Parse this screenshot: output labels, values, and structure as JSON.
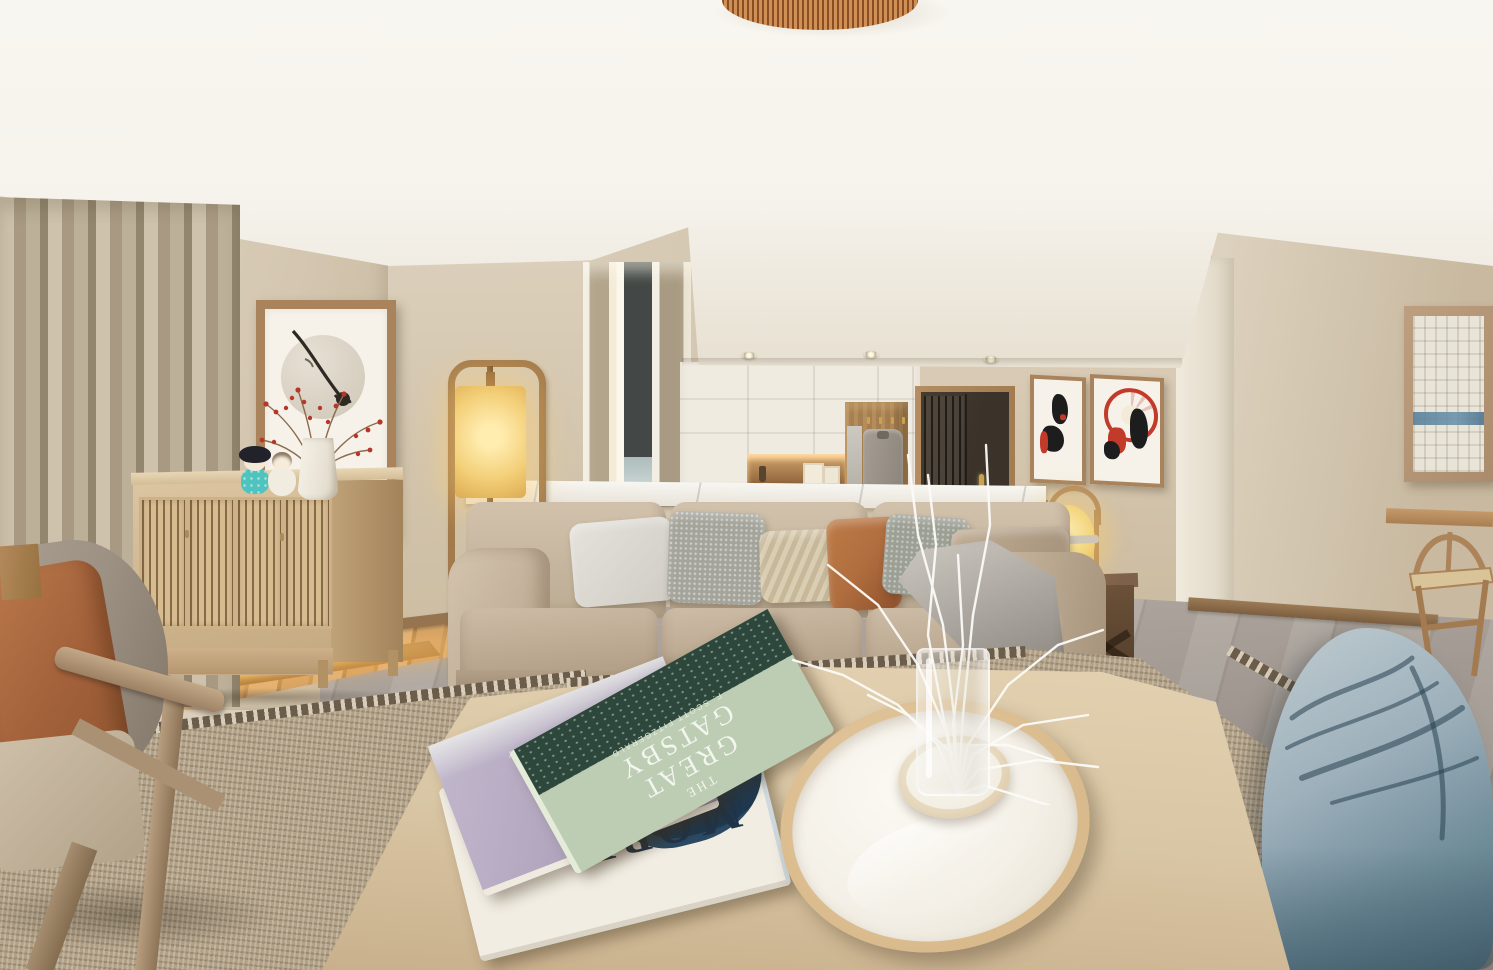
{
  "meta": {
    "description": "Photorealistic 3D render of a Japandi-style open-plan living room with beige sofa, light-wood coffee table, slatted sideboard, kitchen in background and blue bean bag"
  },
  "palette": {
    "ceiling": "#f6f3ec",
    "wall": "#d9cdb9",
    "wall_right": "#d5c9b6",
    "curtain": "#b9ac95",
    "sheer": "#e9e0cf",
    "window_dark": "#3d423f",
    "sky": "#c9d4d4",
    "frame_wood": "#a8835c",
    "art_mat": "#f6f2e9",
    "art_red": "#c23a2a",
    "art_black": "#1d1d1d",
    "cabinet": "#f0ebe1",
    "niche_glow": "#ffd9a0",
    "door": "#3b332a",
    "brass": "#c9a24c",
    "marble": "#edeae2",
    "island_wood": "#b08a60",
    "sideboard": "#d5bd97",
    "platform_glow": "#ffc878",
    "lamp_glow": "#f7d887",
    "lantern_glass": "#f0cf6a",
    "sofa": "#c3b19b",
    "sofa_light": "#d0c0ab",
    "pillow_light": "#dcd9d1",
    "pillow_speck": "#a4a49b",
    "pillow_chevron": "#d6cab0",
    "pillow_rust": "#b06e3f",
    "pillow_taupe": "#b3a089",
    "throw": "#b4b0a8",
    "side_table": "#634a34",
    "tile": "#a79f97",
    "rug": "#b2a186",
    "rug_border": "#6b5d4a",
    "table_wood": "#d9c6a4",
    "tray_rim": "#d9ba8c",
    "tray_inner": "#f4f0e7",
    "beanbag": "#9db0bb",
    "beanbag_dark": "#55707f",
    "book_green": "#bccdb3",
    "book_green_dark": "#2e473d",
    "book_purple": "#b3a7bf",
    "book_white": "#f1ede3",
    "whale": "#1f3950",
    "text_light": "#f5f6f0",
    "berry": "#b7352a",
    "branch": "#fbfaf6",
    "doll_teal": "#4fc3bd",
    "doll_black": "#22222a",
    "chair_wood": "#b08a5f",
    "armchair_back": "#9c9183",
    "coat": "#9a948a",
    "baseboard": "#96744f"
  },
  "books": {
    "gatsby": {
      "line1": "THE",
      "line2": "GREAT",
      "line3": "GATSBY",
      "author": "F. SCOTT FITZGERALD"
    },
    "old_man": {
      "line1": "THE OLD",
      "line2": "MAN",
      "script": "S",
      "author": "ERNEST HEMINGWAY"
    },
    "moby": {
      "title": "MOBY",
      "author": "Herman Melville"
    }
  },
  "objects": {
    "ceiling": "white dropped ceiling with recessed spotlights",
    "pendant": "ribbed rattan pendant lamp at top center",
    "left_wall": "framed zen print with moon circle and dried lotus stem",
    "decor": "kokeshi dolls and white vase with red berry branches on slatted sideboard",
    "platform": "raised oak platform with under-step LED strip",
    "floor_lamp": "wooden rectangle floor lamp with glowing fabric shade",
    "window": "tall window with taupe curtains and sheers",
    "kitchen": "white cabinetry with warm lit niche, coat nook with hanging coat, dark entry door with brass handle",
    "prints": "two ukiyo-e prints beside the door, geisha with red umbrella",
    "textured_art": "white plaster relief artwork with blue stripe on right wall",
    "sofa": "beige three-seat fabric sofa with gray, chevron, rust and taupe pillows and gray throw",
    "lantern": "wood-framed yellow glass lantern lamp on dark wood side table",
    "coffee_table": "oversized light oak coffee table",
    "tray": "oval ceramic tray with riser and glass vase of white branches",
    "rug": "woven jute area rug with dark border",
    "armchair": "wooden armchair with rust cushion in left foreground",
    "beanbag": "slate-blue bean bag in right foreground",
    "chair": "wishbone chair at table on far right"
  }
}
